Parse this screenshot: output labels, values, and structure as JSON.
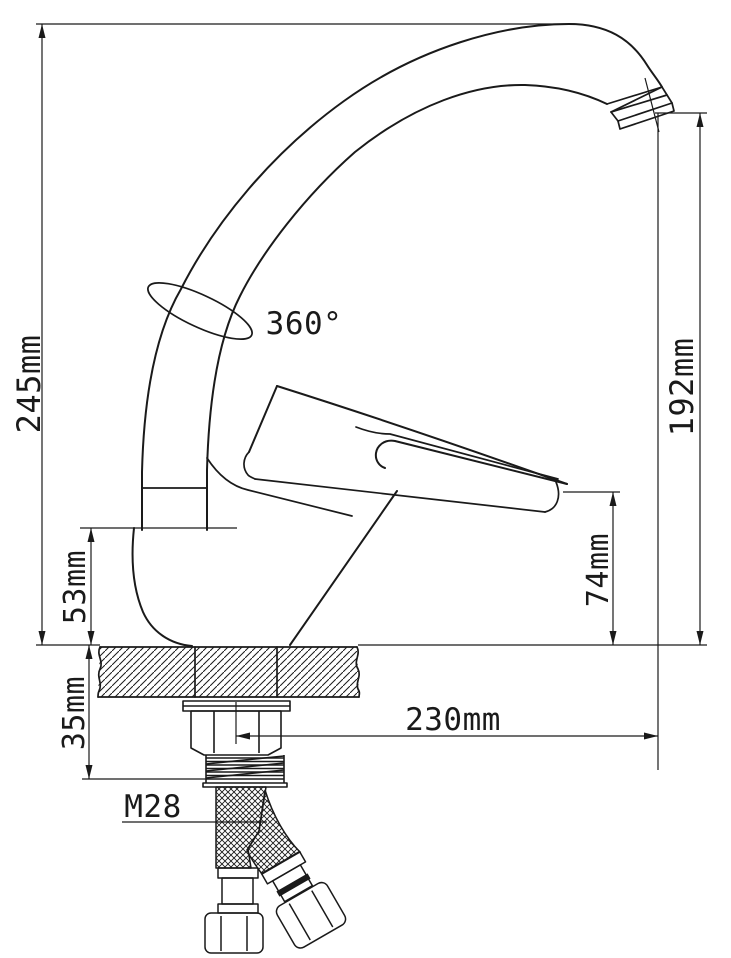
{
  "colors": {
    "background": "#ffffff",
    "line": "#1a1a1a"
  },
  "drawing_type": "faucet-installation-technical-drawing",
  "labels": {
    "total_height": "245mm",
    "swivel_angle": "360°",
    "spout_outlet_height": "192mm",
    "base_height": "53mm",
    "handle_tip_height": "74mm",
    "mounting_depth": "35mm",
    "spout_reach": "230mm",
    "thread_size": "M28"
  }
}
